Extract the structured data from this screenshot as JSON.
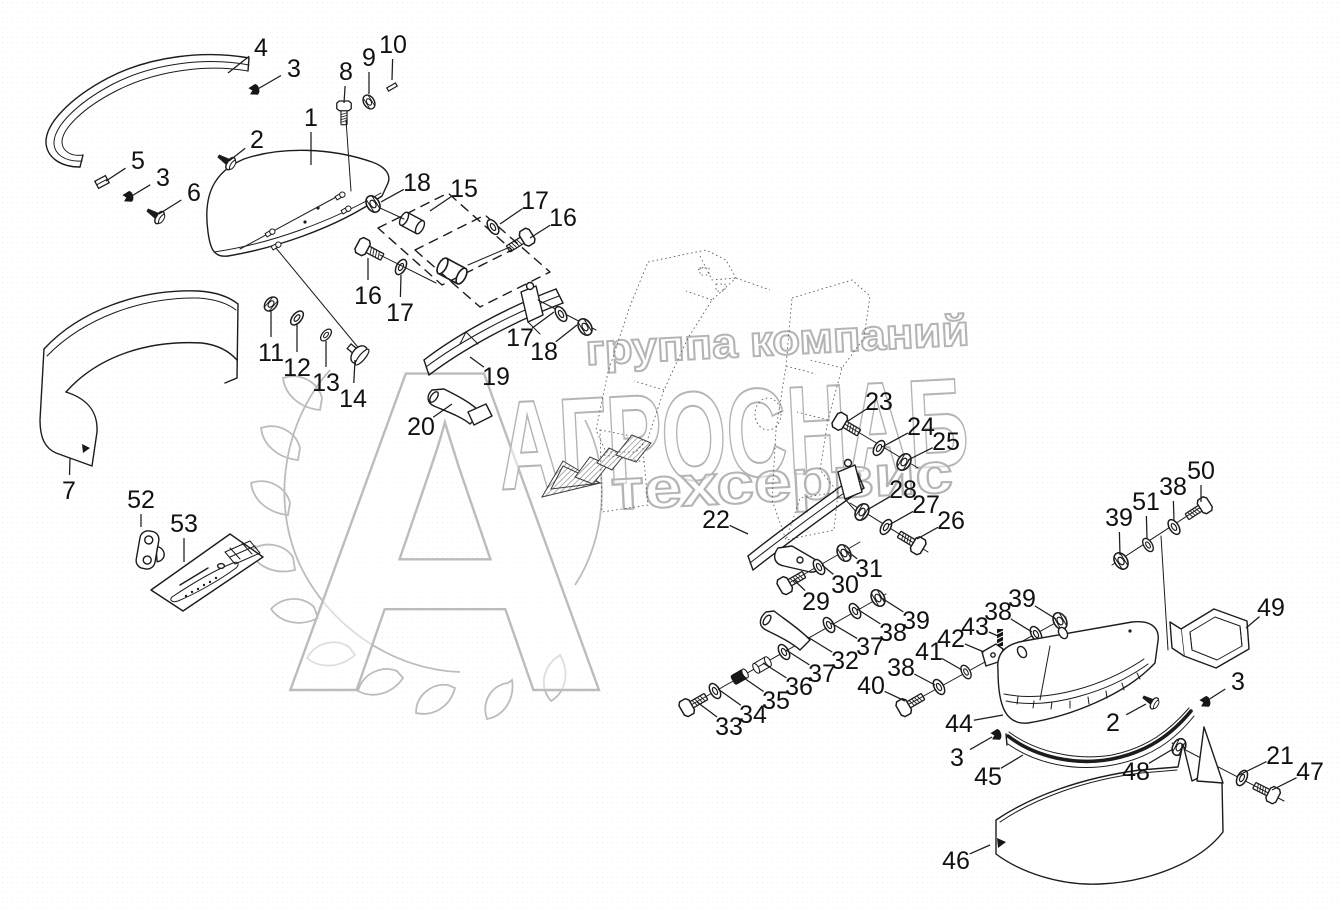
{
  "watermark": {
    "line1": "группа компаний",
    "line2": "АГРОСНАБ",
    "line3": "техсервис",
    "logo_letter": "А",
    "color": "#b4b4b4"
  },
  "diagram": {
    "ink_color": "#1c1c1c",
    "callouts": [
      {
        "n": "1",
        "x": 311,
        "y": 117,
        "tx": 311,
        "ty": 165
      },
      {
        "n": "2",
        "x": 257,
        "y": 139,
        "tx": 229,
        "ty": 161
      },
      {
        "n": "3",
        "x": 294,
        "y": 68,
        "tx": 256,
        "ty": 90
      },
      {
        "n": "4",
        "x": 261,
        "y": 47,
        "tx": 228,
        "ty": 73
      },
      {
        "n": "5",
        "x": 138,
        "y": 160,
        "tx": 106,
        "ty": 181
      },
      {
        "n": "3",
        "x": 163,
        "y": 177,
        "tx": 130,
        "ty": 197
      },
      {
        "n": "6",
        "x": 194,
        "y": 192,
        "tx": 159,
        "ty": 214
      },
      {
        "n": "8",
        "x": 346,
        "y": 71,
        "tx": 344,
        "ty": 103
      },
      {
        "n": "9",
        "x": 369,
        "y": 57,
        "tx": 369,
        "ty": 94
      },
      {
        "n": "10",
        "x": 393,
        "y": 44,
        "tx": 392,
        "ty": 80
      },
      {
        "n": "18",
        "x": 417,
        "y": 182,
        "tx": 381,
        "ty": 202
      },
      {
        "n": "15",
        "x": 464,
        "y": 188,
        "tx": 430,
        "ty": 211
      },
      {
        "n": "17",
        "x": 535,
        "y": 200,
        "tx": 500,
        "ty": 224
      },
      {
        "n": "16",
        "x": 563,
        "y": 217,
        "tx": 530,
        "ty": 238
      },
      {
        "n": "16",
        "x": 368,
        "y": 295,
        "tx": 368,
        "ty": 258
      },
      {
        "n": "17",
        "x": 400,
        "y": 312,
        "tx": 401,
        "ty": 275
      },
      {
        "n": "11",
        "x": 271,
        "y": 352,
        "tx": 271,
        "ty": 311
      },
      {
        "n": "12",
        "x": 297,
        "y": 367,
        "tx": 297,
        "ty": 324
      },
      {
        "n": "13",
        "x": 326,
        "y": 382,
        "tx": 326,
        "ty": 341
      },
      {
        "n": "14",
        "x": 353,
        "y": 398,
        "tx": 355,
        "ty": 360
      },
      {
        "n": "17",
        "x": 520,
        "y": 337,
        "tx": 554,
        "ty": 312
      },
      {
        "n": "18",
        "x": 544,
        "y": 351,
        "tx": 577,
        "ty": 325
      },
      {
        "n": "19",
        "x": 496,
        "y": 376,
        "tx": 470,
        "ty": 357
      },
      {
        "n": "20",
        "x": 421,
        "y": 426,
        "tx": 452,
        "ty": 404
      },
      {
        "n": "22",
        "x": 716,
        "y": 519,
        "tx": 748,
        "ty": 534
      },
      {
        "n": "23",
        "x": 879,
        "y": 401,
        "tx": 848,
        "ty": 421
      },
      {
        "n": "24",
        "x": 921,
        "y": 426,
        "tx": 882,
        "ty": 447
      },
      {
        "n": "25",
        "x": 946,
        "y": 441,
        "tx": 908,
        "ty": 460
      },
      {
        "n": "28",
        "x": 903,
        "y": 489,
        "tx": 867,
        "ty": 510
      },
      {
        "n": "27",
        "x": 926,
        "y": 504,
        "tx": 889,
        "ty": 525
      },
      {
        "n": "26",
        "x": 951,
        "y": 520,
        "tx": 917,
        "ty": 539
      },
      {
        "n": "29",
        "x": 816,
        "y": 601,
        "tx": 794,
        "ty": 580
      },
      {
        "n": "30",
        "x": 845,
        "y": 584,
        "tx": 822,
        "ty": 565
      },
      {
        "n": "31",
        "x": 869,
        "y": 568,
        "tx": 847,
        "ty": 551
      },
      {
        "n": "33",
        "x": 729,
        "y": 726,
        "tx": 697,
        "ty": 702
      },
      {
        "n": "34",
        "x": 753,
        "y": 714,
        "tx": 718,
        "ty": 689
      },
      {
        "n": "35",
        "x": 776,
        "y": 700,
        "tx": 741,
        "ty": 676
      },
      {
        "n": "36",
        "x": 799,
        "y": 686,
        "tx": 763,
        "ty": 663
      },
      {
        "n": "37",
        "x": 822,
        "y": 673,
        "tx": 786,
        "ty": 650
      },
      {
        "n": "32",
        "x": 845,
        "y": 660,
        "tx": 806,
        "ty": 636
      },
      {
        "n": "37",
        "x": 870,
        "y": 646,
        "tx": 831,
        "ty": 623
      },
      {
        "n": "38",
        "x": 893,
        "y": 632,
        "tx": 857,
        "ty": 609
      },
      {
        "n": "39",
        "x": 916,
        "y": 620,
        "tx": 880,
        "ty": 597
      },
      {
        "n": "40",
        "x": 871,
        "y": 685,
        "tx": 905,
        "ty": 701
      },
      {
        "n": "38",
        "x": 901,
        "y": 667,
        "tx": 935,
        "ty": 685
      },
      {
        "n": "41",
        "x": 929,
        "y": 651,
        "tx": 962,
        "ty": 670
      },
      {
        "n": "42",
        "x": 951,
        "y": 638,
        "tx": 984,
        "ty": 652
      },
      {
        "n": "43",
        "x": 975,
        "y": 626,
        "tx": 998,
        "ty": 636
      },
      {
        "n": "38",
        "x": 998,
        "y": 611,
        "tx": 1032,
        "ty": 632
      },
      {
        "n": "39",
        "x": 1022,
        "y": 598,
        "tx": 1056,
        "ty": 619
      },
      {
        "n": "39",
        "x": 1119,
        "y": 517,
        "tx": 1120,
        "ty": 555
      },
      {
        "n": "51",
        "x": 1146,
        "y": 501,
        "tx": 1147,
        "ty": 539
      },
      {
        "n": "38",
        "x": 1173,
        "y": 486,
        "tx": 1174,
        "ty": 521
      },
      {
        "n": "50",
        "x": 1201,
        "y": 470,
        "tx": 1201,
        "ty": 502
      },
      {
        "n": "49",
        "x": 1271,
        "y": 607,
        "tx": 1246,
        "ty": 628
      },
      {
        "n": "44",
        "x": 959,
        "y": 723,
        "tx": 1003,
        "ty": 715
      },
      {
        "n": "2",
        "x": 1113,
        "y": 722,
        "tx": 1146,
        "ty": 704
      },
      {
        "n": "3",
        "x": 1238,
        "y": 681,
        "tx": 1208,
        "ty": 700
      },
      {
        "n": "3",
        "x": 957,
        "y": 757,
        "tx": 992,
        "ty": 737
      },
      {
        "n": "45",
        "x": 988,
        "y": 776,
        "tx": 1023,
        "ty": 755
      },
      {
        "n": "48",
        "x": 1136,
        "y": 771,
        "tx": 1173,
        "ty": 749
      },
      {
        "n": "21",
        "x": 1280,
        "y": 755,
        "tx": 1237,
        "ty": 776
      },
      {
        "n": "47",
        "x": 1310,
        "y": 771,
        "tx": 1272,
        "ty": 790
      },
      {
        "n": "46",
        "x": 956,
        "y": 860,
        "tx": 990,
        "ty": 845
      },
      {
        "n": "7",
        "x": 69,
        "y": 490,
        "tx": 70,
        "ty": 458
      },
      {
        "n": "52",
        "x": 141,
        "y": 499,
        "tx": 141,
        "ty": 527
      },
      {
        "n": "53",
        "x": 184,
        "y": 523,
        "tx": 184,
        "ty": 562
      }
    ]
  }
}
